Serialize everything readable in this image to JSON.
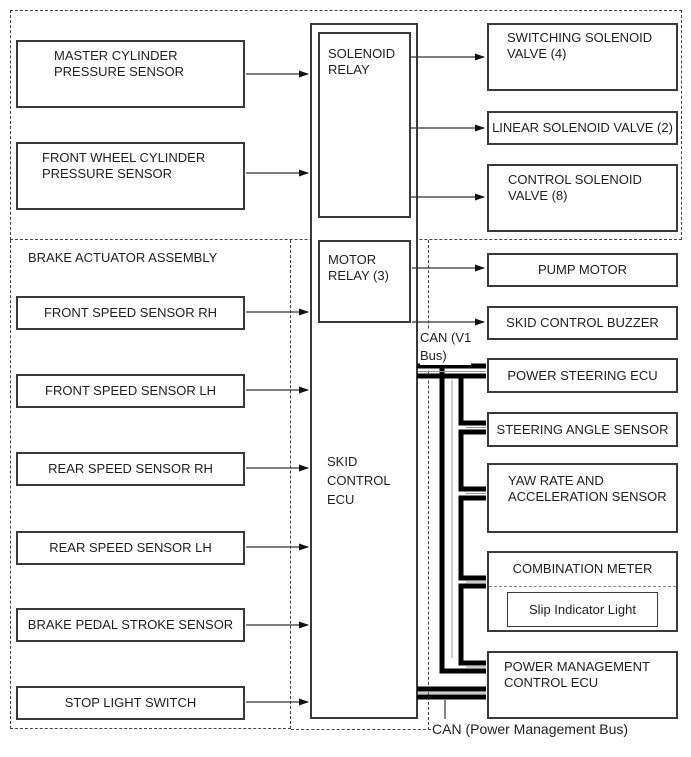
{
  "diagram_title": "Brake actuator / skid control ECU wiring diagram",
  "colors": {
    "box_border": "#3a3a3a",
    "signal_line": "#333333",
    "can_bus": "#000000",
    "dashed_outline": "#444444",
    "background": "#ffffff"
  },
  "brake_assembly_label": "BRAKE ACTUATOR ASSEMBLY",
  "left_boxes": [
    {
      "label": "MASTER CYLINDER\nPRESSURE SENSOR"
    },
    {
      "label": "FRONT WHEEL CYLINDER\nPRESSURE SENSOR"
    },
    {
      "label": "FRONT SPEED SENSOR RH"
    },
    {
      "label": "FRONT SPEED SENSOR LH"
    },
    {
      "label": "REAR SPEED SENSOR RH"
    },
    {
      "label": "REAR SPEED SENSOR LH"
    },
    {
      "label": "BRAKE PEDAL STROKE SENSOR"
    },
    {
      "label": "STOP LIGHT SWITCH"
    }
  ],
  "center": {
    "solenoid_relay": "SOLENOID\nRELAY",
    "motor_relay": "MOTOR\nRELAY (3)",
    "skid_control_ecu": "SKID\nCONTROL\nECU"
  },
  "right_boxes": [
    {
      "label": "SWITCHING SOLENOID\nVALVE (4)"
    },
    {
      "label": "LINEAR SOLENOID VALVE (2)"
    },
    {
      "label": "CONTROL SOLENOID\nVALVE (8)"
    },
    {
      "label": "PUMP MOTOR"
    },
    {
      "label": "SKID CONTROL BUZZER"
    },
    {
      "label": "POWER STEERING ECU"
    },
    {
      "label": "STEERING ANGLE SENSOR"
    },
    {
      "label": "YAW RATE AND\nACCELERATION SENSOR"
    },
    {
      "label": "POWER MANAGEMENT\nCONTROL ECU"
    }
  ],
  "combination_meter": {
    "title": "COMBINATION METER",
    "slip_indicator": "Slip Indicator Light"
  },
  "can_labels": {
    "v1": "CAN (V1\nBus)",
    "power_management": "CAN (Power Management Bus)"
  }
}
